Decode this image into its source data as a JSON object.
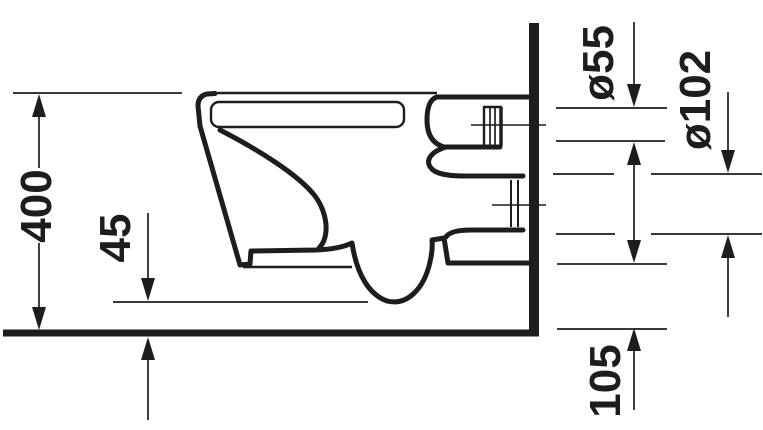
{
  "drawing": {
    "type": "technical-dimension-drawing",
    "subject": "wall-hung toilet side elevation",
    "colors": {
      "line": "#1d1d1b",
      "background": "#ffffff"
    },
    "labels": {
      "overall_height": "400",
      "underside_clearance": "45",
      "flush_connection_diameter": "ø55",
      "outlet_diameter": "ø102",
      "outlet_bottom_height": "105"
    }
  }
}
